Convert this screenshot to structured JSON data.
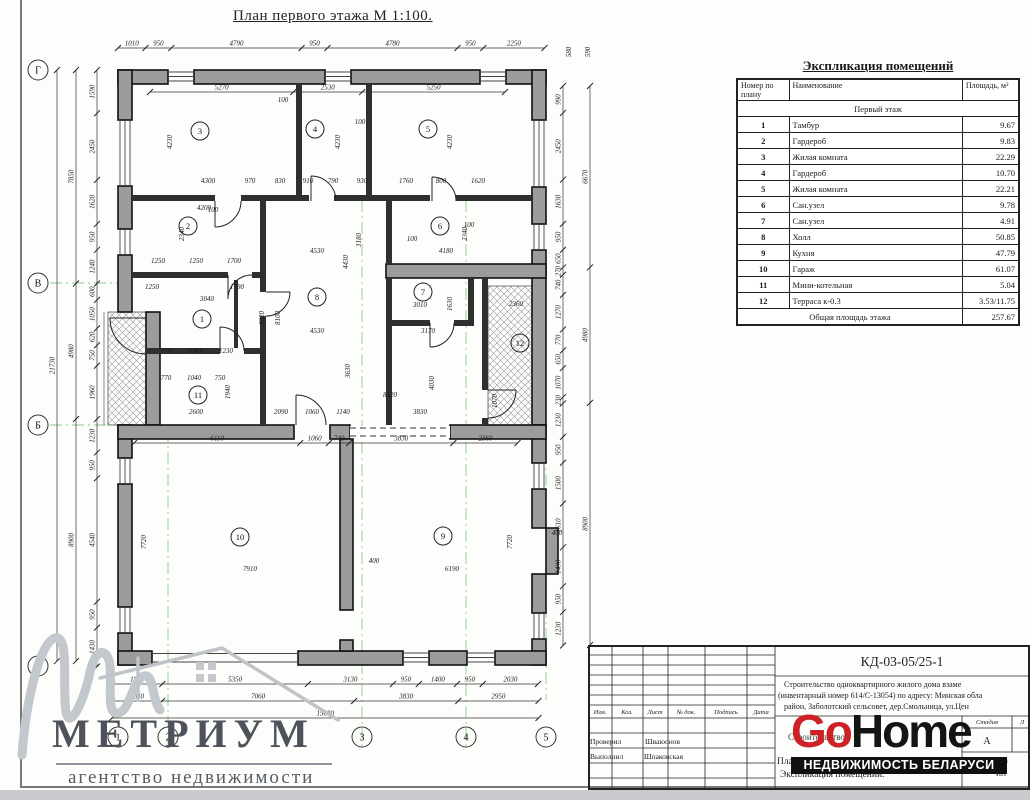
{
  "plan": {
    "title": "План первого этажа М 1:100.",
    "grid_rows": [
      {
        "label": "Г",
        "x": 38,
        "y": 70
      },
      {
        "label": "В",
        "x": 38,
        "y": 283
      },
      {
        "label": "Б",
        "x": 38,
        "y": 425
      },
      {
        "label": "А",
        "x": 38,
        "y": 666
      }
    ],
    "grid_cols": [
      {
        "label": "1",
        "x": 118,
        "y": 737
      },
      {
        "label": "2",
        "x": 168,
        "y": 737
      },
      {
        "label": "3",
        "x": 362,
        "y": 737
      },
      {
        "label": "4",
        "x": 466,
        "y": 737
      },
      {
        "label": "5",
        "x": 546,
        "y": 737
      }
    ],
    "rooms": [
      {
        "n": "3",
        "x": 200,
        "y": 131
      },
      {
        "n": "4",
        "x": 315,
        "y": 129
      },
      {
        "n": "5",
        "x": 428,
        "y": 129
      },
      {
        "n": "2",
        "x": 188,
        "y": 226
      },
      {
        "n": "6",
        "x": 440,
        "y": 226
      },
      {
        "n": "8",
        "x": 317,
        "y": 297
      },
      {
        "n": "7",
        "x": 423,
        "y": 292
      },
      {
        "n": "1",
        "x": 202,
        "y": 319
      },
      {
        "n": "12",
        "x": 520,
        "y": 343
      },
      {
        "n": "11",
        "x": 198,
        "y": 395
      },
      {
        "n": "10",
        "x": 240,
        "y": 537
      },
      {
        "n": "9",
        "x": 443,
        "y": 536
      }
    ],
    "chains": [
      {
        "axis": "h",
        "at": 48,
        "from": 118,
        "vals": [
          1010,
          950,
          4790,
          950,
          4780,
          950,
          2250
        ]
      },
      {
        "axis": "h",
        "at": 92,
        "from": 150,
        "vals": [
          5270,
          2530,
          5250
        ]
      },
      {
        "axis": "h",
        "at": 443,
        "from": 134,
        "vals": [
          6110,
          1060,
          740,
          3830,
          2360
        ]
      },
      {
        "axis": "h",
        "at": 684,
        "from": 112,
        "vals": [
          1850,
          5350,
          3130,
          950,
          1400,
          950,
          2030
        ]
      },
      {
        "axis": "h",
        "at": 701,
        "from": 112,
        "vals": [
          1840,
          7060,
          3830,
          2950
        ]
      },
      {
        "axis": "h",
        "at": 718,
        "from": 112,
        "vals": [
          15680
        ]
      },
      {
        "axis": "v",
        "at": 97,
        "from": 70,
        "vals": [
          1590,
          2450,
          1620,
          950,
          1240,
          600,
          1050,
          620,
          750,
          1960,
          1230,
          950,
          4540,
          950,
          1430
        ]
      },
      {
        "axis": "v",
        "at": 76,
        "from": 70,
        "vals": [
          7850,
          4980,
          8900
        ]
      },
      {
        "axis": "v",
        "at": 57,
        "from": 70,
        "vals": [
          21730
        ]
      },
      {
        "axis": "v",
        "at": 563,
        "from": 86,
        "vals": [
          990,
          2450,
          1630,
          950,
          650,
          270,
          740,
          1270,
          770,
          650,
          1070,
          230,
          1230,
          950,
          1500,
          1610,
          1430,
          950,
          1230
        ]
      },
      {
        "axis": "v",
        "at": 590,
        "from": 86,
        "vals": [
          6670,
          4980,
          8900
        ]
      }
    ],
    "free_labels": [
      {
        "v": "580",
        "x": 571,
        "y": 52,
        "r": -90
      },
      {
        "v": "590",
        "x": 590,
        "y": 52,
        "r": -90
      },
      {
        "v": "4230",
        "x": 172,
        "y": 142,
        "r": -90
      },
      {
        "v": "4230",
        "x": 340,
        "y": 142,
        "r": -90
      },
      {
        "v": "4230",
        "x": 452,
        "y": 142,
        "r": -90
      },
      {
        "v": "100",
        "x": 283,
        "y": 102
      },
      {
        "v": "100",
        "x": 360,
        "y": 124
      },
      {
        "v": "100",
        "x": 213,
        "y": 212
      },
      {
        "v": "100",
        "x": 412,
        "y": 241
      },
      {
        "v": "100",
        "x": 469,
        "y": 227
      },
      {
        "v": "4300",
        "x": 208,
        "y": 183
      },
      {
        "v": "970",
        "x": 250,
        "y": 183
      },
      {
        "v": "830",
        "x": 280,
        "y": 183
      },
      {
        "v": "910",
        "x": 308,
        "y": 183
      },
      {
        "v": "790",
        "x": 333,
        "y": 183
      },
      {
        "v": "930",
        "x": 362,
        "y": 183
      },
      {
        "v": "1760",
        "x": 406,
        "y": 183
      },
      {
        "v": "800",
        "x": 441,
        "y": 183
      },
      {
        "v": "1620",
        "x": 478,
        "y": 183
      },
      {
        "v": "4200",
        "x": 204,
        "y": 210
      },
      {
        "v": "2340",
        "x": 184,
        "y": 234,
        "r": -90
      },
      {
        "v": "2340",
        "x": 467,
        "y": 234,
        "r": -90
      },
      {
        "v": "4530",
        "x": 317,
        "y": 253
      },
      {
        "v": "4180",
        "x": 446,
        "y": 253
      },
      {
        "v": "3180",
        "x": 361,
        "y": 240,
        "r": -90
      },
      {
        "v": "4430",
        "x": 348,
        "y": 262,
        "r": -90
      },
      {
        "v": "1250",
        "x": 158,
        "y": 263
      },
      {
        "v": "1250",
        "x": 196,
        "y": 263
      },
      {
        "v": "1700",
        "x": 234,
        "y": 263
      },
      {
        "v": "1250",
        "x": 152,
        "y": 289
      },
      {
        "v": "1790",
        "x": 237,
        "y": 289
      },
      {
        "v": "3040",
        "x": 207,
        "y": 301
      },
      {
        "v": "8100",
        "x": 280,
        "y": 318,
        "r": -90
      },
      {
        "v": "3820",
        "x": 264,
        "y": 318,
        "r": -90
      },
      {
        "v": "4530",
        "x": 317,
        "y": 333
      },
      {
        "v": "3170",
        "x": 428,
        "y": 333
      },
      {
        "v": "3010",
        "x": 420,
        "y": 307
      },
      {
        "v": "1630",
        "x": 452,
        "y": 304,
        "r": -90
      },
      {
        "v": "770",
        "x": 166,
        "y": 353
      },
      {
        "v": "1040",
        "x": 194,
        "y": 353
      },
      {
        "v": "1230",
        "x": 226,
        "y": 353
      },
      {
        "v": "770",
        "x": 166,
        "y": 380
      },
      {
        "v": "1040",
        "x": 194,
        "y": 380
      },
      {
        "v": "750",
        "x": 220,
        "y": 380
      },
      {
        "v": "1940",
        "x": 230,
        "y": 392,
        "r": -90
      },
      {
        "v": "2600",
        "x": 196,
        "y": 414
      },
      {
        "v": "2090",
        "x": 281,
        "y": 414
      },
      {
        "v": "1060",
        "x": 312,
        "y": 414
      },
      {
        "v": "1140",
        "x": 343,
        "y": 414
      },
      {
        "v": "8120",
        "x": 390,
        "y": 397
      },
      {
        "v": "3830",
        "x": 420,
        "y": 414
      },
      {
        "v": "3630",
        "x": 350,
        "y": 371,
        "r": -90
      },
      {
        "v": "4030",
        "x": 434,
        "y": 383,
        "r": -90
      },
      {
        "v": "1070",
        "x": 497,
        "y": 401,
        "r": -90
      },
      {
        "v": "2360",
        "x": 516,
        "y": 306
      },
      {
        "v": "7720",
        "x": 146,
        "y": 542,
        "r": -90
      },
      {
        "v": "7720",
        "x": 512,
        "y": 542,
        "r": -90
      },
      {
        "v": "7910",
        "x": 250,
        "y": 571
      },
      {
        "v": "400",
        "x": 374,
        "y": 563
      },
      {
        "v": "6190",
        "x": 452,
        "y": 571
      },
      {
        "v": "400",
        "x": 557,
        "y": 535
      }
    ]
  },
  "explication": {
    "title": "Экспликация помещений",
    "col_headers": [
      "Номер по плану",
      "Наименование",
      "Площадь, м²"
    ],
    "section": "Первый этаж",
    "rows": [
      {
        "num": "1",
        "name": "Тамбур",
        "area": "9.67"
      },
      {
        "num": "2",
        "name": "Гардероб",
        "area": "9.83"
      },
      {
        "num": "3",
        "name": "Жилая комната",
        "area": "22.29"
      },
      {
        "num": "4",
        "name": "Гардероб",
        "area": "10.70"
      },
      {
        "num": "5",
        "name": "Жилая комната",
        "area": "22.21"
      },
      {
        "num": "6",
        "name": "Сан.узел",
        "area": "9.78"
      },
      {
        "num": "7",
        "name": "Сан.узел",
        "area": "4.91"
      },
      {
        "num": "8",
        "name": "Холл",
        "area": "50.85"
      },
      {
        "num": "9",
        "name": "Кухня",
        "area": "47.79"
      },
      {
        "num": "10",
        "name": "Гараж",
        "area": "61.07"
      },
      {
        "num": "11",
        "name": "Мини-котельная",
        "area": "5.04"
      },
      {
        "num": "12",
        "name": "Терраса к-0.3",
        "area": "3.53/11.75"
      }
    ],
    "total_label": "Общая площадь этажа",
    "total_value": "257.67"
  },
  "titleblock": {
    "doc_number": "КД-03-05/25-1",
    "desc_line1": "Строительство одноквартирного жилого дома взаме",
    "desc_line2": "(инвентарный номер 614/С-13054) по адресу: Минская обла",
    "desc_line3": "район, Заболотский сельсовет, дер.Смольница, ул.Цен",
    "header_cells": [
      "Изм.",
      "Кол.",
      "Лист",
      "№ док.",
      "Подпись",
      "Дата"
    ],
    "row_checked_label": "Проверил",
    "row_checked_value": "Шваюонов",
    "row_made_label": "Выполнил",
    "row_made_value": "Шпаковская",
    "stage_label": "Стадия",
    "sheet_label": "Л",
    "stage_value": "А",
    "name_fragment": "Строительство",
    "plan_fragment": "Пла",
    "subject_line": "Экспликация помещений.",
    "corner_line1": "Lu",
    "corner_line2": "ИП"
  },
  "branding": {
    "metrium": "МЕТРИУМ",
    "metrium_sub": "агентство недвижимости",
    "gohome_go": "Go",
    "gohome_home": "Home",
    "gohome_sub": "НЕДВИЖИМОСТЬ БЕЛАРУСИ",
    "gohome_red": "#cb2127",
    "gohome_black": "#141414"
  }
}
